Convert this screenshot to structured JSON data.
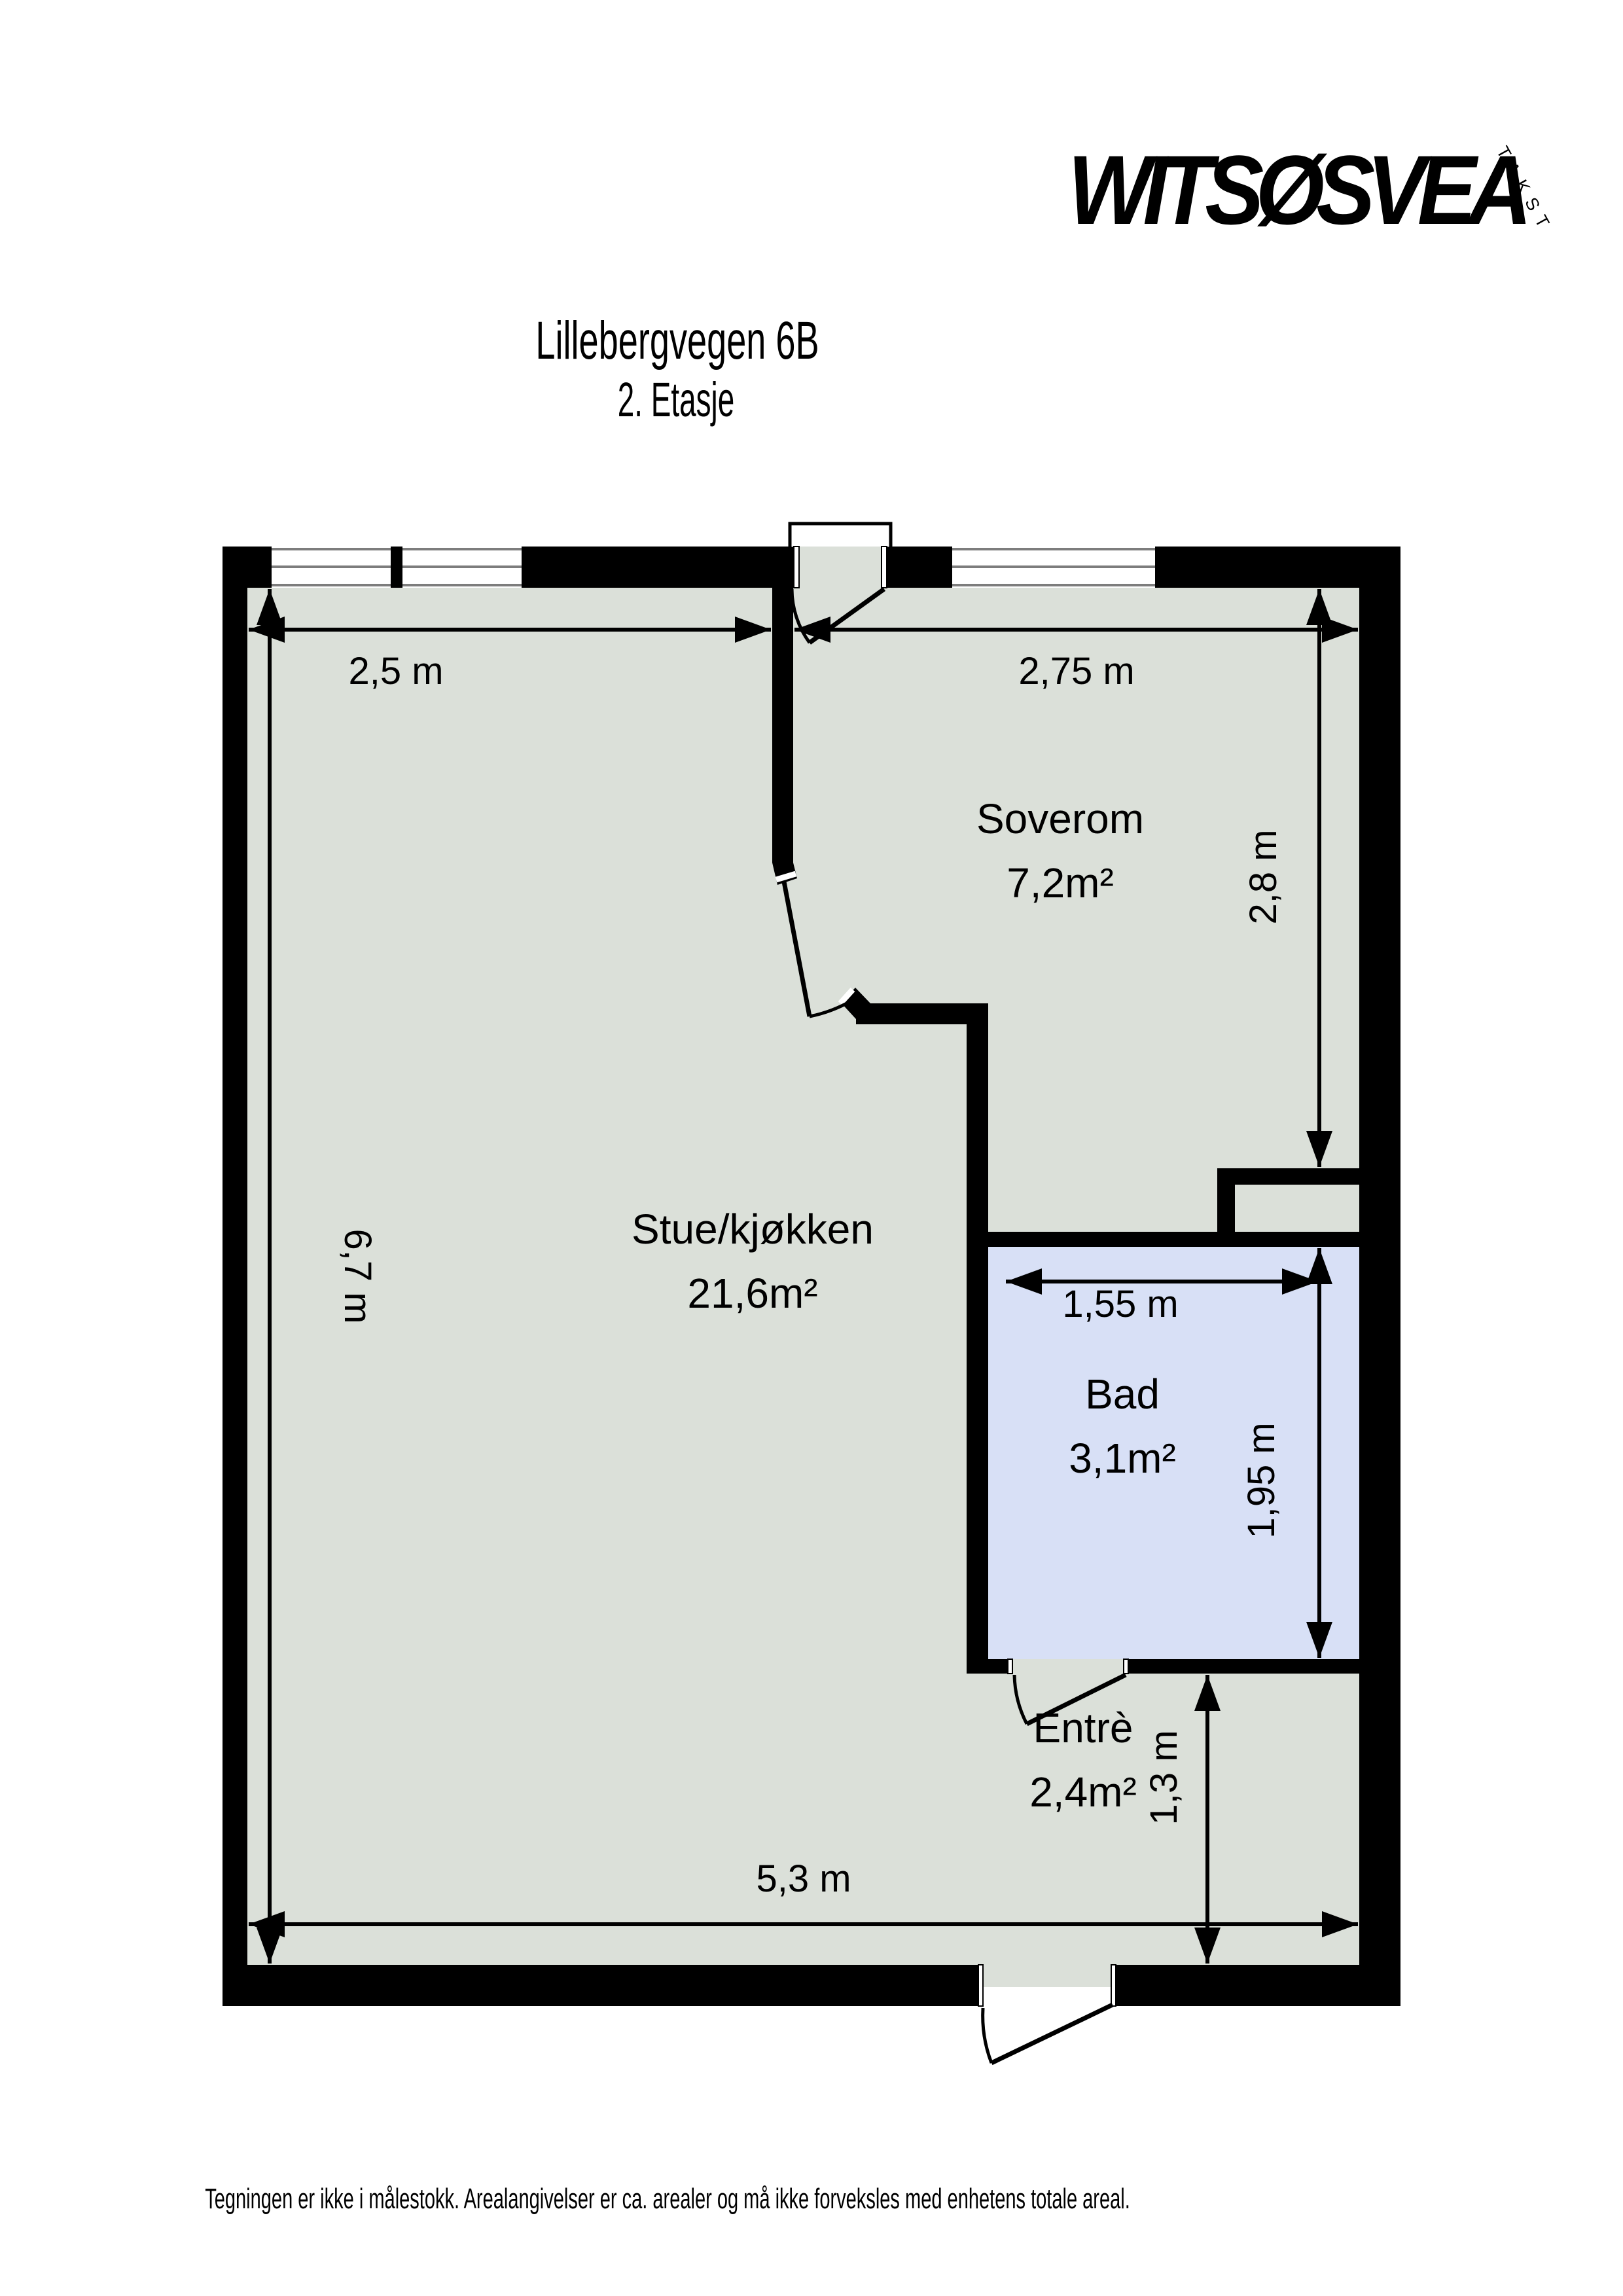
{
  "header": {
    "title": "Lillebergvegen 6B",
    "subtitle": "2. Etasje"
  },
  "logo": {
    "brand": "WITSØSVEA",
    "tagline": "TAKST"
  },
  "floorplan": {
    "colors": {
      "wall": "#000000",
      "floor": "#dbe0d9",
      "bathroom_floor": "#d8e0f6",
      "window_frame": "#7d7d7d"
    },
    "rooms": [
      {
        "name": "Stue/kjøkken",
        "area": "21,6m²"
      },
      {
        "name": "Soverom",
        "area": "7,2m²"
      },
      {
        "name": "Bad",
        "area": "3,1m²"
      },
      {
        "name": "Entrè",
        "area": "2,4m²"
      }
    ],
    "dimensions": {
      "stue_width": "2,5 m",
      "soverom_width": "2,75 m",
      "soverom_height": "2,8 m",
      "stue_height": "6,7 m",
      "bad_width": "1,55 m",
      "bad_height": "1,95 m",
      "entre_height": "1,3 m",
      "total_width": "5,3 m"
    }
  },
  "footer": {
    "disclaimer": "Tegningen er ikke i målestokk. Arealangivelser er ca. arealer og må ikke forveksles med enhetens totale areal."
  }
}
